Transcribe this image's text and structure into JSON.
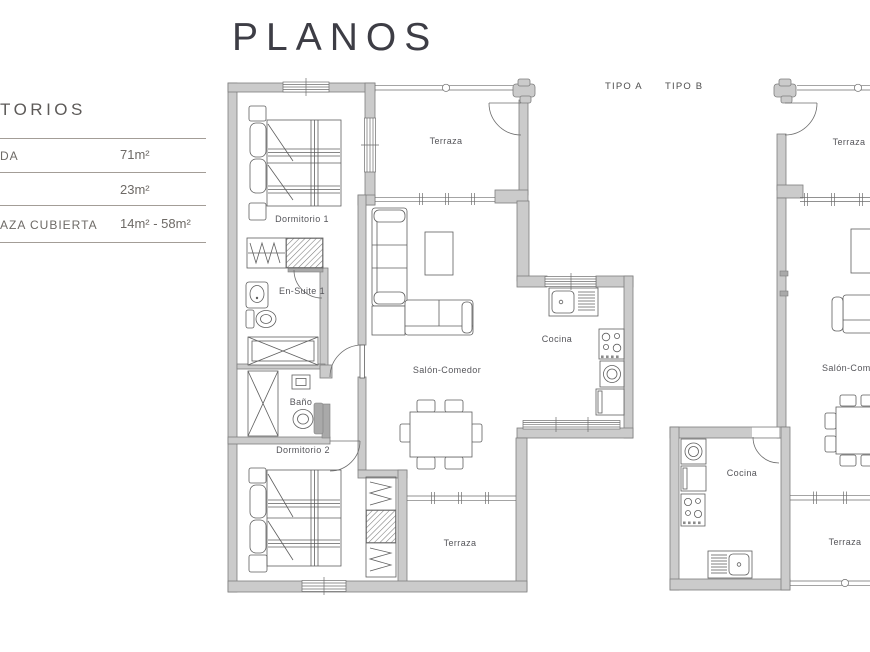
{
  "page_title": "PLANOS",
  "legend": {
    "heading": "TORIOS",
    "rows": [
      {
        "label": "DA",
        "value": "71m²"
      },
      {
        "label": "",
        "value": "23m²"
      },
      {
        "label": "AZA CUBIERTA",
        "value": "14m² - 58m²"
      }
    ]
  },
  "plan_labels": {
    "tipo_a": "TIPO A",
    "tipo_b": "TIPO B"
  },
  "tipo_a_rooms": {
    "terraza_top": "Terraza",
    "dormitorio1": "Dormitorio 1",
    "ensuite1": "En-Suite 1",
    "salon": "Salón-Comedor",
    "cocina": "Cocina",
    "bano": "Baño",
    "dormitorio2": "Dormitorio 2",
    "terraza_bottom": "Terraza"
  },
  "tipo_b_rooms": {
    "terraza_top": "Terraza",
    "salon": "Salón-Com",
    "cocina": "Cocina",
    "terraza_bottom": "Terraza"
  },
  "colors": {
    "wall_fill": "#cbcbcb",
    "wall_stroke": "#7e7e7e",
    "furniture_stroke": "#5f5f5f",
    "room_label_text": "#55555a",
    "title_text": "#3d3d45",
    "legend_line": "#a39d97",
    "legend_text": "#6e6a66"
  }
}
